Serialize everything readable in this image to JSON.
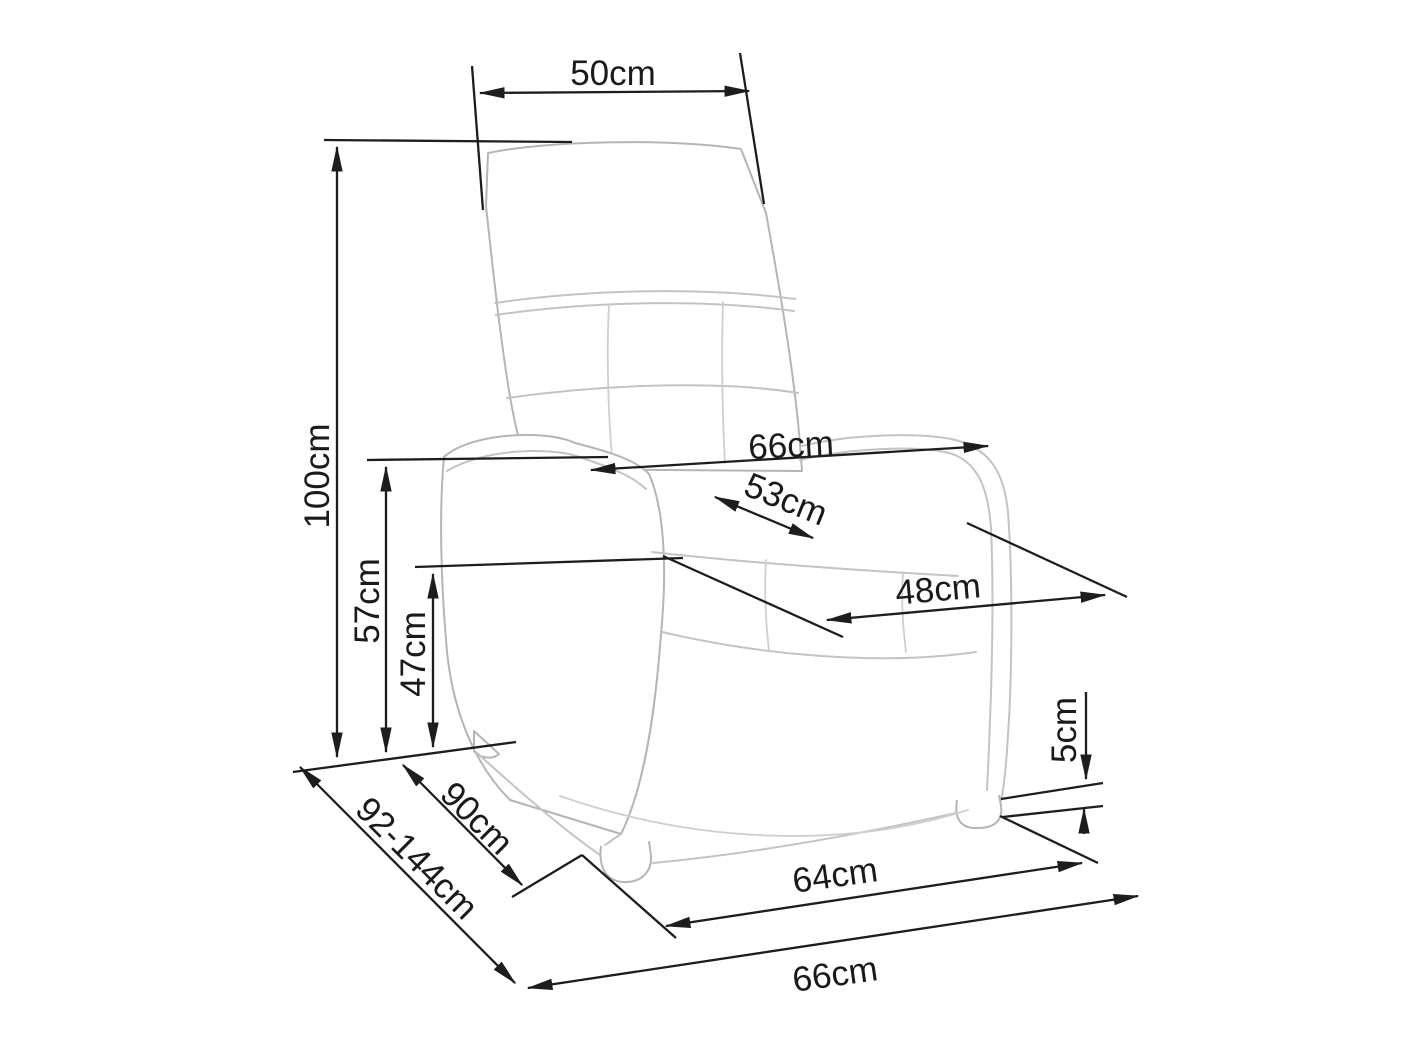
{
  "colors": {
    "background": "#ffffff",
    "dimension_lines": "#1d1d1d",
    "sketch_lines": "#c3c3c3",
    "text": "#1a1a1a"
  },
  "unit": "cm",
  "labels": {
    "headrest_width": "50cm",
    "overall_height": "100cm",
    "armrest_height": "57cm",
    "seat_height": "47cm",
    "armrest_span_width": "66cm",
    "seat_width": "53cm",
    "seat_depth": "48cm",
    "foot_height": "5cm",
    "base_depth": "90cm",
    "depth_extended_range": "92-144cm",
    "front_feet_span": "64cm",
    "overall_width": "66cm"
  }
}
